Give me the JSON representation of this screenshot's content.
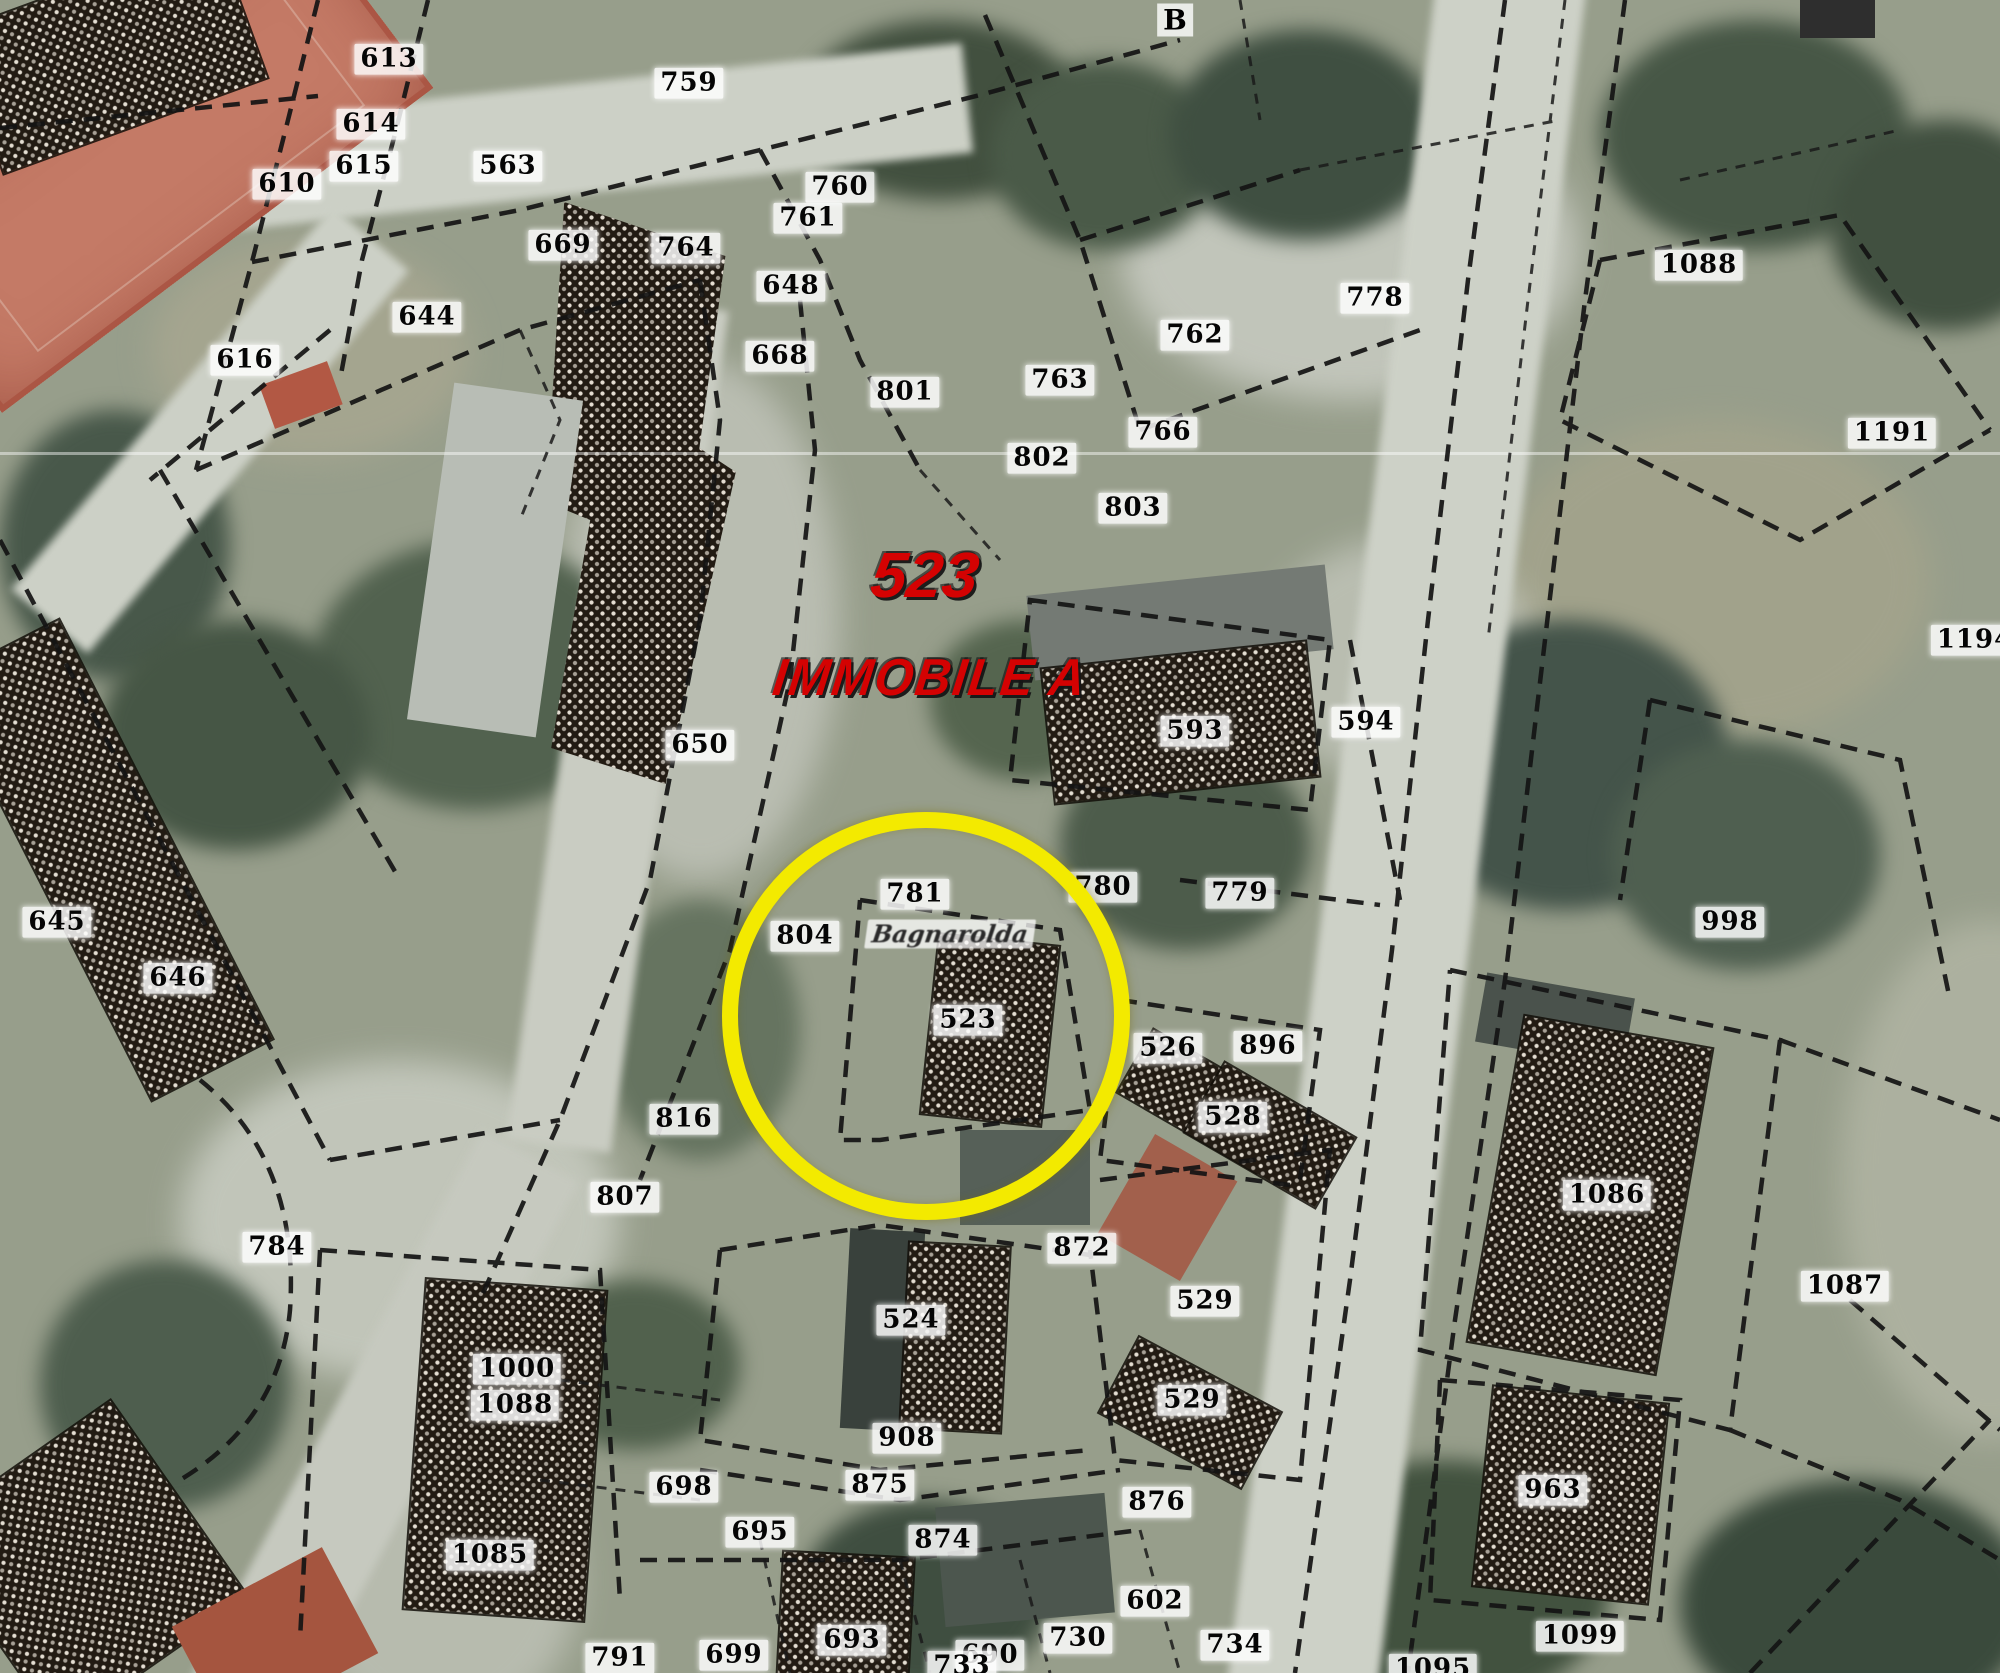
{
  "map": {
    "kind": "Cadastral parcel overlay on aerial photo",
    "annotations": {
      "parcel_headline": "523",
      "property_headline": "IMMOBILE A",
      "color": "#d40202"
    },
    "locality_label": "Bagnarolda",
    "sheet_letter": "B",
    "highlight": {
      "shape": "circle",
      "color": "#f3ea00",
      "parcel": "523",
      "cx": 910,
      "cy": 1000,
      "r": 180
    },
    "line_color": "#141414",
    "label_box_color": "#ffffff",
    "tennis_court_color": "#c47a66"
  },
  "parcels": [
    {
      "id": "613",
      "x": 389,
      "y": 59
    },
    {
      "id": "614",
      "x": 371,
      "y": 124
    },
    {
      "id": "615",
      "x": 364,
      "y": 166
    },
    {
      "id": "610",
      "x": 287,
      "y": 184
    },
    {
      "id": "563",
      "x": 508,
      "y": 166
    },
    {
      "id": "759",
      "x": 689,
      "y": 83
    },
    {
      "id": "760",
      "x": 840,
      "y": 187
    },
    {
      "id": "761",
      "x": 808,
      "y": 218
    },
    {
      "id": "669",
      "x": 563,
      "y": 245
    },
    {
      "id": "764",
      "x": 686,
      "y": 248
    },
    {
      "id": "648",
      "x": 791,
      "y": 286
    },
    {
      "id": "668",
      "x": 780,
      "y": 356
    },
    {
      "id": "644",
      "x": 427,
      "y": 317
    },
    {
      "id": "616",
      "x": 245,
      "y": 360
    },
    {
      "id": "801",
      "x": 905,
      "y": 392
    },
    {
      "id": "763",
      "x": 1060,
      "y": 380
    },
    {
      "id": "766",
      "x": 1163,
      "y": 432
    },
    {
      "id": "762",
      "x": 1195,
      "y": 335
    },
    {
      "id": "802",
      "x": 1042,
      "y": 458
    },
    {
      "id": "803",
      "x": 1133,
      "y": 508
    },
    {
      "id": "778",
      "x": 1375,
      "y": 298
    },
    {
      "id": "1088",
      "x": 1699,
      "y": 265
    },
    {
      "id": "1191",
      "x": 1892,
      "y": 433
    },
    {
      "id": "1194",
      "x": 1975,
      "y": 640
    },
    {
      "id": "650",
      "x": 700,
      "y": 745
    },
    {
      "id": "593",
      "x": 1195,
      "y": 731
    },
    {
      "id": "594",
      "x": 1366,
      "y": 722
    },
    {
      "id": "781",
      "x": 915,
      "y": 894
    },
    {
      "id": "780",
      "x": 1103,
      "y": 887
    },
    {
      "id": "779",
      "x": 1240,
      "y": 893
    },
    {
      "id": "804",
      "x": 805,
      "y": 936
    },
    {
      "id": "523",
      "x": 968,
      "y": 1020
    },
    {
      "id": "998",
      "x": 1730,
      "y": 922
    },
    {
      "id": "645",
      "x": 57,
      "y": 922
    },
    {
      "id": "646",
      "x": 178,
      "y": 978
    },
    {
      "id": "784",
      "x": 277,
      "y": 1247
    },
    {
      "id": "816",
      "x": 684,
      "y": 1119
    },
    {
      "id": "807",
      "x": 625,
      "y": 1197
    },
    {
      "id": "872",
      "x": 1082,
      "y": 1248
    },
    {
      "id": "526",
      "x": 1168,
      "y": 1048
    },
    {
      "id": "896",
      "x": 1268,
      "y": 1046
    },
    {
      "id": "528",
      "x": 1233,
      "y": 1117
    },
    {
      "id": "524",
      "x": 911,
      "y": 1320
    },
    {
      "id": "529",
      "x": 1205,
      "y": 1301
    },
    {
      "id": "529",
      "x": 1192,
      "y": 1400
    },
    {
      "id": "1000",
      "x": 517,
      "y": 1369
    },
    {
      "id": "1088",
      "x": 515,
      "y": 1405
    },
    {
      "id": "1085",
      "x": 490,
      "y": 1555
    },
    {
      "id": "698",
      "x": 684,
      "y": 1487
    },
    {
      "id": "695",
      "x": 760,
      "y": 1532
    },
    {
      "id": "875",
      "x": 880,
      "y": 1485
    },
    {
      "id": "908",
      "x": 907,
      "y": 1438
    },
    {
      "id": "874",
      "x": 943,
      "y": 1540
    },
    {
      "id": "876",
      "x": 1157,
      "y": 1502
    },
    {
      "id": "602",
      "x": 1155,
      "y": 1601
    },
    {
      "id": "730",
      "x": 1078,
      "y": 1638
    },
    {
      "id": "690",
      "x": 990,
      "y": 1655
    },
    {
      "id": "699",
      "x": 734,
      "y": 1655
    },
    {
      "id": "693",
      "x": 852,
      "y": 1640
    },
    {
      "id": "733",
      "x": 962,
      "y": 1666
    },
    {
      "id": "734",
      "x": 1235,
      "y": 1645
    },
    {
      "id": "791",
      "x": 620,
      "y": 1658
    },
    {
      "id": "963",
      "x": 1553,
      "y": 1490
    },
    {
      "id": "1099",
      "x": 1580,
      "y": 1636
    },
    {
      "id": "1095",
      "x": 1433,
      "y": 1669
    },
    {
      "id": "1086",
      "x": 1607,
      "y": 1195
    },
    {
      "id": "1087",
      "x": 1845,
      "y": 1286
    }
  ]
}
